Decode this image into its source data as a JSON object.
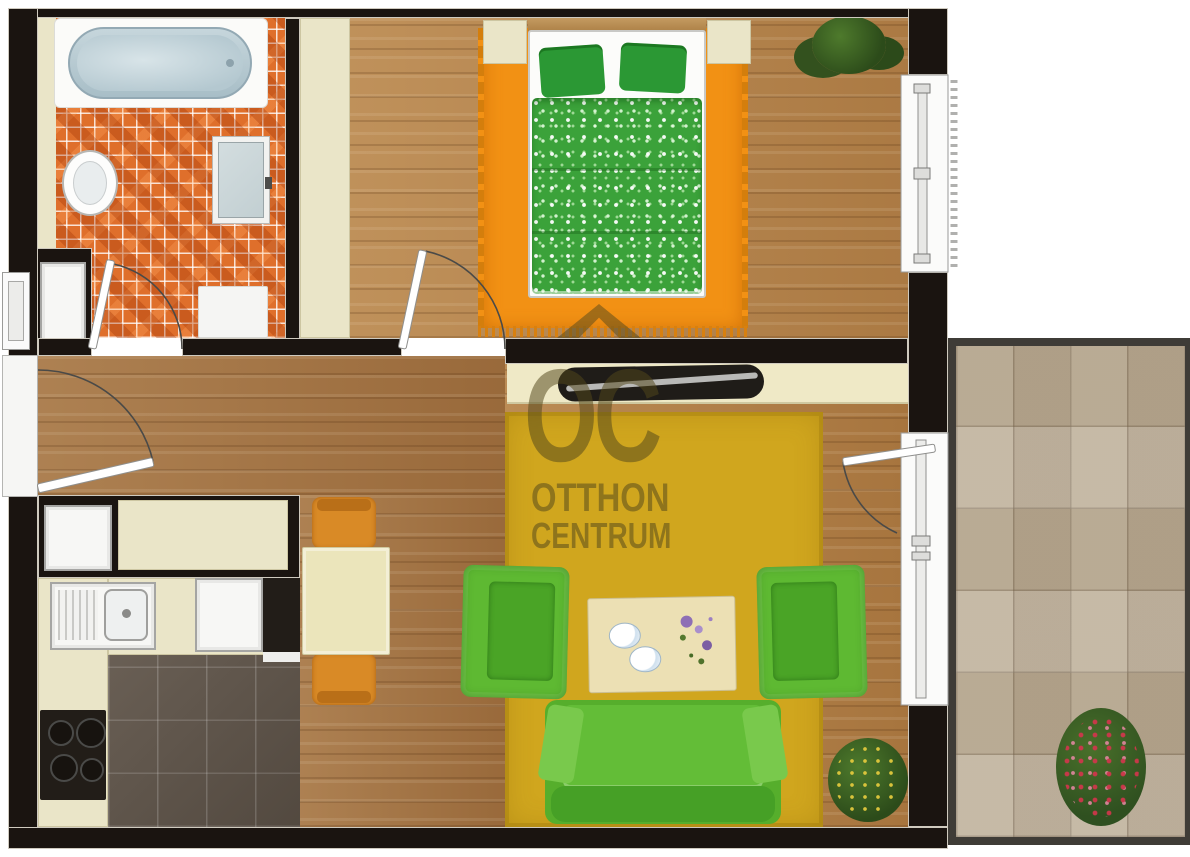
{
  "watermark": {
    "logo_text": "OC",
    "line1": "OTTHON",
    "line2": "CENTRUM"
  },
  "palette": {
    "wall": "#1a1410",
    "wood_floor": "#aa7840",
    "bathroom_tile_orange": "#df6f2b",
    "kitchen_tile_brown": "#60554a",
    "balcony_tile_beige": "#b8aa94",
    "bedroom_rug_orange": "#f29114",
    "living_rug_yellow": "#d0a61e",
    "sofa_green": "#5eb932",
    "bedding_green": "#3ba23a",
    "closet_cream": "#eae5c8",
    "chair_orange": "#d98a26",
    "watermark_olive": "rgba(82,71,27,0.52)"
  }
}
